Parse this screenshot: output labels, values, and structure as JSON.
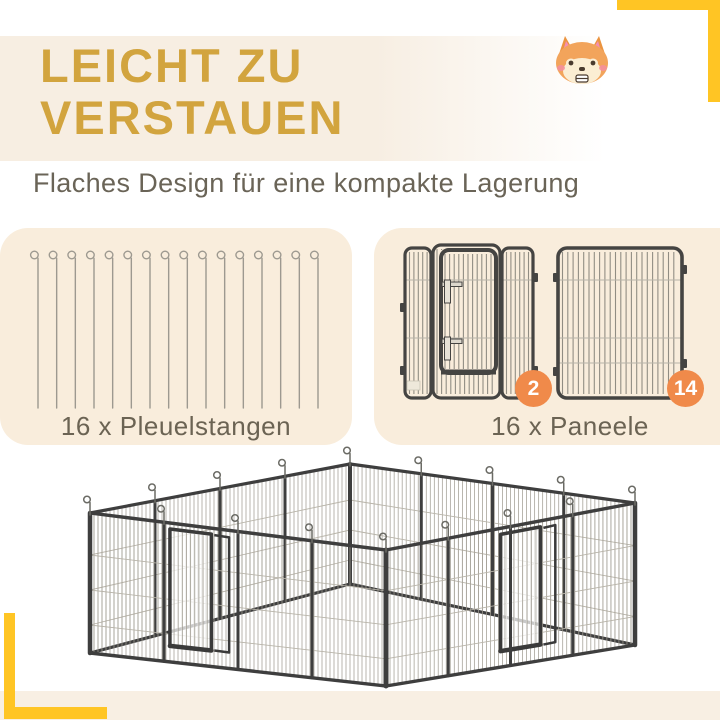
{
  "header": {
    "title_lines": [
      "LEICHT ZU",
      "VERSTAUEN"
    ],
    "subtitle": "Flaches Design für eine kompakte Lagerung"
  },
  "mascot": {
    "icon": "corgi-face-icon"
  },
  "parts": {
    "rods": {
      "count": 16,
      "label": "16 x Pleuelstangen"
    },
    "panels": {
      "count": 16,
      "label": "16 x Paneele",
      "door_panel_badge": "2",
      "plain_panel_badge": "14"
    }
  },
  "colors": {
    "accent_yellow": "#ffc524",
    "heading_gold": "#d2a43e",
    "badge_orange": "#f08a4a",
    "card_bg": "#f9eddc",
    "strip_bg": "#f8efe3",
    "text_dark": "#6a6457",
    "label_text": "#6b6353",
    "frame_dark": "#454442",
    "mesh_gray": "#a29e94",
    "wire_gray": "#b8b4a9",
    "pin_gray": "#9d9990",
    "pen_pin_gray": "#6b6b65"
  }
}
